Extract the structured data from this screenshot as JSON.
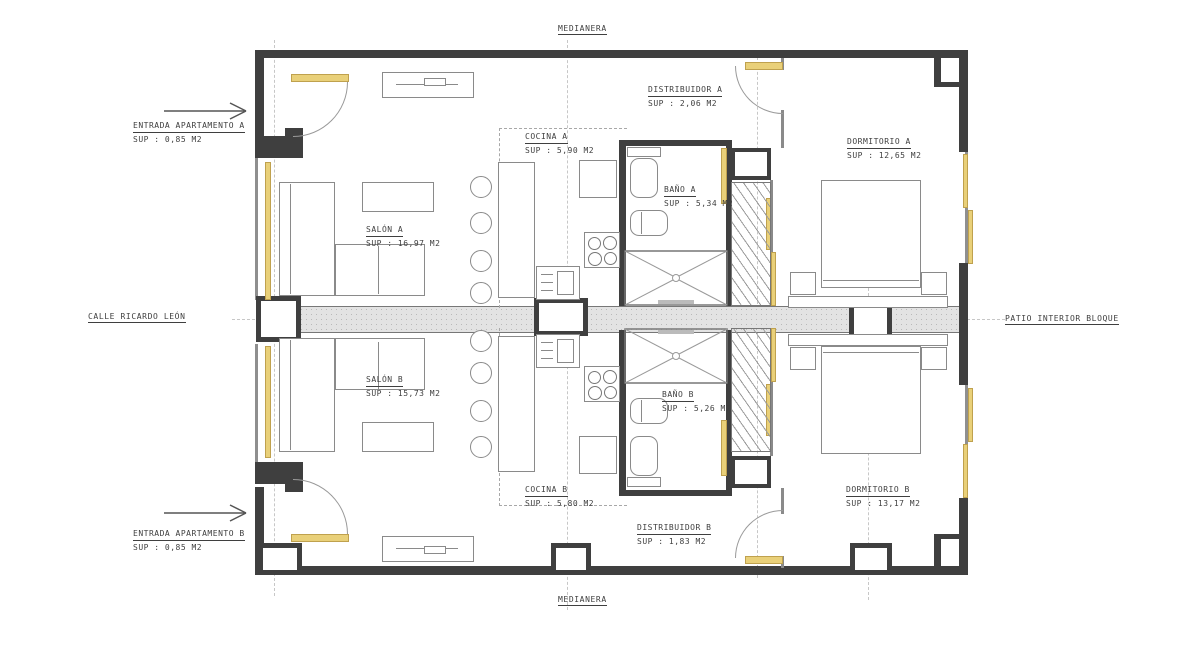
{
  "plan": {
    "site_labels": {
      "top": "MEDIANERA",
      "bottom": "MEDIANERA",
      "left": "CALLE RICARDO LEÓN",
      "right": "PATIO INTERIOR BLOQUE"
    },
    "entrances": {
      "a": {
        "name": "ENTRADA APARTAMENTO A",
        "sup": "SUP : 0,85 M2"
      },
      "b": {
        "name": "ENTRADA APARTAMENTO B",
        "sup": "SUP : 0,85 M2"
      }
    },
    "rooms": {
      "distribuidor_a": {
        "name": "DISTRIBUIDOR A",
        "sup": "SUP : 2,06 M2"
      },
      "cocina_a": {
        "name": "COCINA A",
        "sup": "SUP : 5,90 M2"
      },
      "dormitorio_a": {
        "name": "DORMITORIO A",
        "sup": "SUP : 12,65 M2"
      },
      "bano_a": {
        "name": "BAÑO A",
        "sup": "SUP : 5,34 M2"
      },
      "salon_a": {
        "name": "SALÓN A",
        "sup": "SUP : 16,97 M2"
      },
      "salon_b": {
        "name": "SALÓN B",
        "sup": "SUP : 15,73 M2"
      },
      "bano_b": {
        "name": "BAÑO B",
        "sup": "SUP : 5,26 M2"
      },
      "cocina_b": {
        "name": "COCINA B",
        "sup": "SUP : 5,80 M2"
      },
      "dormitorio_b": {
        "name": "DORMITORIO B",
        "sup": "SUP : 13,17 M2"
      },
      "distribuidor_b": {
        "name": "DISTRIBUIDOR B",
        "sup": "SUP : 1,83 M2"
      }
    },
    "colors": {
      "wall": "#3f3f3f",
      "line": "#8a8a8a",
      "carpentry": "#e9d079",
      "text": "#3f3f3f"
    }
  }
}
